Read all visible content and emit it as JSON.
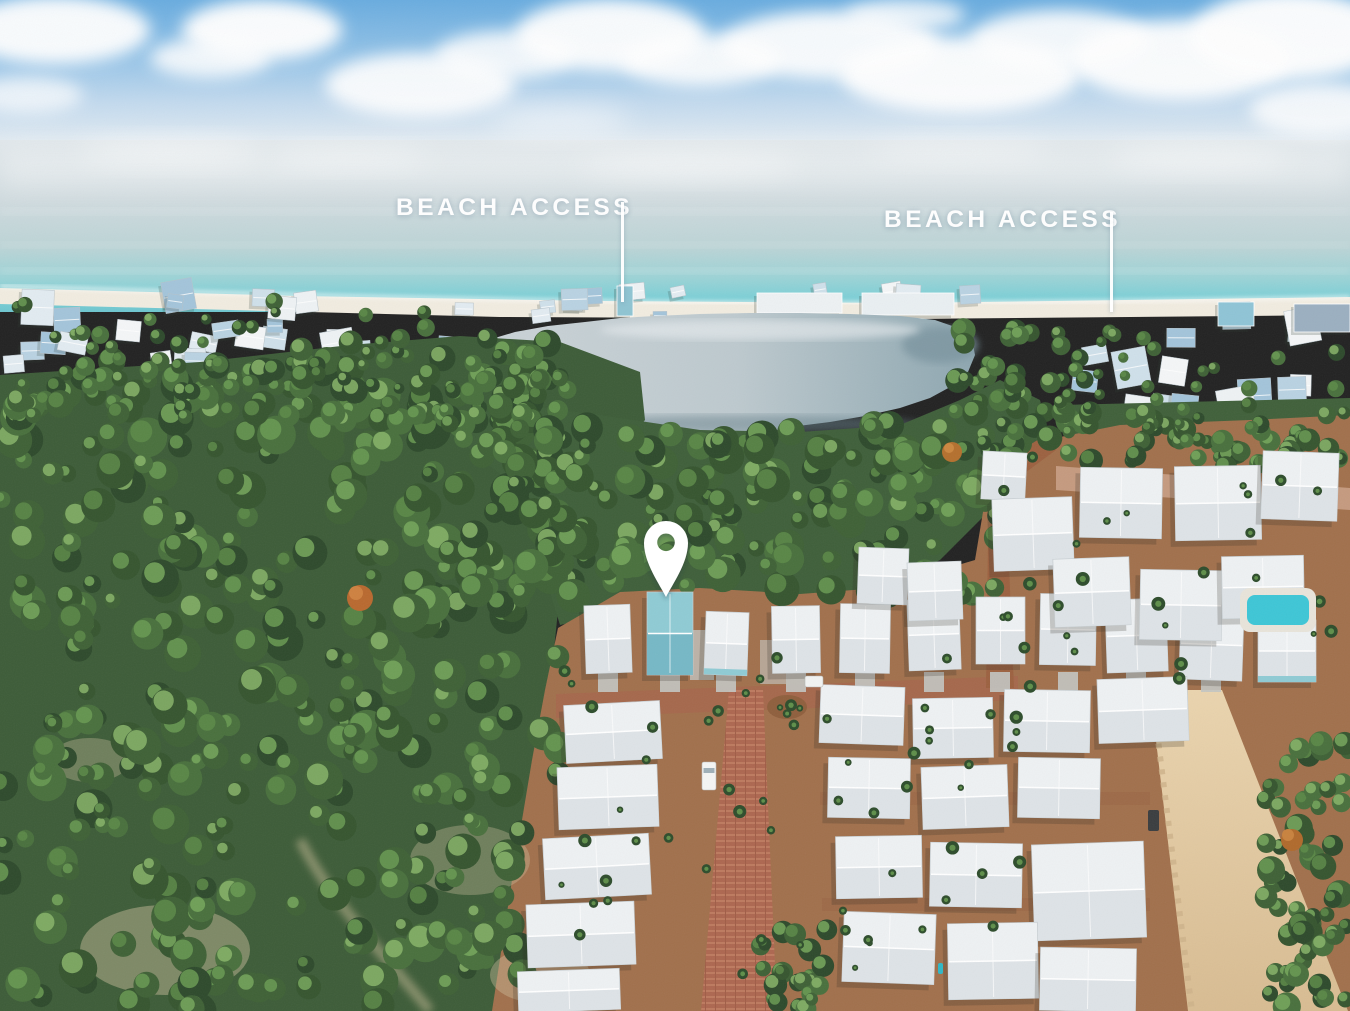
{
  "annotations": {
    "beach_access_left": "BEACH ACCESS",
    "beach_access_right": "BEACH ACCESS"
  },
  "marker": {
    "color": "#ffffff"
  },
  "palette": {
    "sky_top": "#69ACDF",
    "sky_horizon": "#ECF1F4",
    "ocean_far": "#DFE6EA",
    "ocean_near": "#6EC6CF",
    "sand": "#F1ECE0",
    "lake_light": "#CCD4D8",
    "lake_deep": "#8EA6B0",
    "forest_dark": "#3D5C38",
    "roof_white": "#EEF1F3",
    "roof_shade": "#D9E0E4",
    "wall_teal": "#8FCBD4",
    "ground": "#A1704C",
    "road_brick": "#B06A52",
    "road_dirt": "#9C6140",
    "road_sand": "#EAD4AE",
    "pool": "#3EC6D6",
    "label_text": "#FFFFFF"
  }
}
